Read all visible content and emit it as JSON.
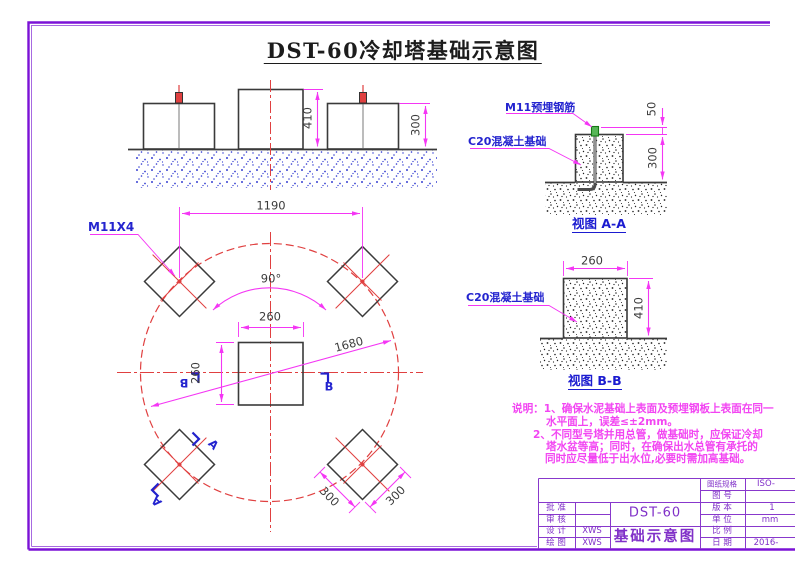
{
  "title": "DST-60冷却塔基础示意图",
  "elevation": {
    "dim_center_height": "410",
    "dim_side_height": "300"
  },
  "view_aa": {
    "label_rebar": "M11预埋钢筋",
    "label_concrete": "C20混凝土基础",
    "dim_embed": "50",
    "dim_height": "300",
    "caption": "视图 A-A"
  },
  "view_bb": {
    "label_concrete": "C20混凝土基础",
    "dim_width": "260",
    "dim_height": "410",
    "caption": "视图 B-B"
  },
  "plan": {
    "label_anchor": "M11X4",
    "dim_spacing": "1190",
    "dim_angle": "90°",
    "dim_square_w": "260",
    "dim_square_h": "260",
    "dim_diagonal": "1680",
    "dim_pad_side_1": "300",
    "dim_pad_side_2": "300",
    "section_a": "A",
    "section_b": "B"
  },
  "notes": {
    "line1": "说明：1、确保水泥基础上表面及预埋钢板上表面在同一",
    "line2": "水平面上，误差≤±2mm。",
    "line3": "2、不同型号塔并用总管，做基础时，应保证冷却",
    "line4": "塔水盆等高；同时，在确保出水总管有承托的",
    "line5": "同时应尽量低于出水位,必要时需加高基础。"
  },
  "title_block": {
    "model": "DST-60",
    "drawing_name": "基础示意图",
    "rows_left": [
      {
        "label": "批 准",
        "value": ""
      },
      {
        "label": "审 核",
        "value": ""
      },
      {
        "label": "设 计",
        "value": "XWS"
      },
      {
        "label": "绘 图",
        "value": "XWS"
      }
    ],
    "rows_right": [
      {
        "label": "图纸规格",
        "value": "ISO-"
      },
      {
        "label": "图 号",
        "value": ""
      },
      {
        "label": "版 本",
        "value": "1"
      },
      {
        "label": "单 位",
        "value": "mm"
      },
      {
        "label": "比 例",
        "value": ""
      },
      {
        "label": "日 期",
        "value": "2016-"
      }
    ]
  },
  "colors": {
    "frame": "#7b12d6",
    "title_block": "#8838cc",
    "dimension": "#f436f4",
    "centerline": "#e04040",
    "label_blue": "#2424cf",
    "outline": "#3a3a3a",
    "notes": "#f245f2"
  }
}
